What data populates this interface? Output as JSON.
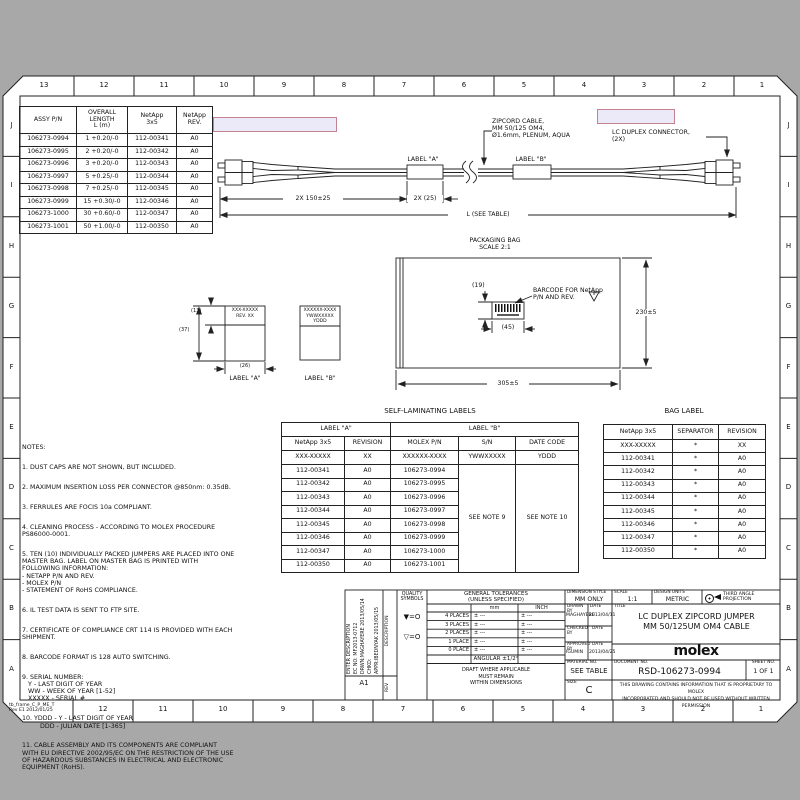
{
  "frame": {
    "cols_top": [
      "13",
      "12",
      "11",
      "10",
      "9",
      "8",
      "7",
      "6",
      "5",
      "4",
      "3",
      "2",
      "1"
    ],
    "cols_bottom": [
      "12",
      "11",
      "10",
      "9",
      "8",
      "7",
      "6",
      "5",
      "4",
      "3",
      "2",
      "1"
    ],
    "rows_left": [
      "J",
      "I",
      "H",
      "G",
      "F",
      "E",
      "D",
      "C",
      "B",
      "A"
    ],
    "rows_right": [
      "J",
      "I",
      "H",
      "G",
      "F",
      "E",
      "D",
      "C",
      "B",
      "A"
    ],
    "stamp": "tb_frame_C_P_ME_T\nRev E1 2012/01/25"
  },
  "assy_table": {
    "headers": [
      "ASSY P/N",
      "OVERALL\nLENGTH\nL (m)",
      "NetApp\n3x5",
      "NetApp\nREV."
    ],
    "rows": [
      [
        "106273-0994",
        "1 +0.20/-0",
        "112-00341",
        "A0"
      ],
      [
        "106273-0995",
        "2 +0.20/-0",
        "112-00342",
        "A0"
      ],
      [
        "106273-0996",
        "3 +0.20/-0",
        "112-00343",
        "A0"
      ],
      [
        "106273-0997",
        "5 +0.25/-0",
        "112-00344",
        "A0"
      ],
      [
        "106273-0998",
        "7 +0.25/-0",
        "112-00345",
        "A0"
      ],
      [
        "106273-0999",
        "15 +0.30/-0",
        "112-00346",
        "A0"
      ],
      [
        "106273-1000",
        "30 +0.60/-0",
        "112-00347",
        "A0"
      ],
      [
        "106273-1001",
        "50 +1.00/-0",
        "112-00350",
        "A0"
      ]
    ]
  },
  "cable": {
    "callout_cable": "ZIPCORD CABLE,\nMM 50/125 OM4,\nØ1.6mm, PLENUM, AQUA",
    "callout_connector": "LC DUPLEX CONNECTOR,\n(2X)",
    "label_a": "LABEL \"A\"",
    "label_b": "LABEL \"B\"",
    "dim_boot": "2X 150±25",
    "dim_label": "2X (25)",
    "dim_length": "L (SEE TABLE)"
  },
  "bag": {
    "title": "PACKAGING BAG\nSCALE 2:1",
    "dim_height": "230±5",
    "dim_width": "305±5",
    "dim_barcode_h": "(19)",
    "dim_barcode_w": "(45)",
    "callout_barcode": "BARCODE FOR NetApp\nP/N AND REV.",
    "flag": "V"
  },
  "labels_detail": {
    "a_text": "XXX-XXXXX\nREV. XX",
    "b_text": "XXXXXX-XXXX\nYWWXXXXX\nYDDD",
    "dim_13": "(13)",
    "dim_37": "(37)",
    "dim_26": "(26)",
    "caption_a": "LABEL \"A\"",
    "caption_b": "LABEL \"B\""
  },
  "selflam": {
    "title": "SELF-LAMINATING LABELS",
    "group_a": "LABEL \"A\"",
    "group_b": "LABEL \"B\"",
    "headers": [
      "NetApp 3x5",
      "REVISION",
      "MOLEX P/N",
      "S/N",
      "DATE CODE"
    ],
    "template_row": [
      "XXX-XXXXX",
      "XX",
      "XXXXXX-XXXX",
      "YWWXXXXX",
      "YDDD"
    ],
    "rows": [
      [
        "112-00341",
        "A0",
        "106273-0994"
      ],
      [
        "112-00342",
        "A0",
        "106273-0995"
      ],
      [
        "112-00343",
        "A0",
        "106273-0996"
      ],
      [
        "112-00344",
        "A0",
        "106273-0997"
      ],
      [
        "112-00345",
        "A0",
        "106273-0998"
      ],
      [
        "112-00346",
        "A0",
        "106273-0999"
      ],
      [
        "112-00347",
        "A0",
        "106273-1000"
      ],
      [
        "112-00350",
        "A0",
        "106273-1001"
      ]
    ],
    "sn_note": "SEE NOTE 9",
    "date_note": "SEE NOTE 10"
  },
  "baglabel": {
    "title": "BAG LABEL",
    "headers": [
      "NetApp 3x5",
      "SEPARATOR",
      "REVISION"
    ],
    "rows": [
      [
        "XXX-XXXXX",
        "*",
        "XX"
      ],
      [
        "112-00341",
        "*",
        "A0"
      ],
      [
        "112-00342",
        "*",
        "A0"
      ],
      [
        "112-00343",
        "*",
        "A0"
      ],
      [
        "112-00344",
        "*",
        "A0"
      ],
      [
        "112-00345",
        "*",
        "A0"
      ],
      [
        "112-00346",
        "*",
        "A0"
      ],
      [
        "112-00347",
        "*",
        "A0"
      ],
      [
        "112-00350",
        "*",
        "A0"
      ]
    ]
  },
  "notes": {
    "title": "NOTES:",
    "items": [
      "1. DUST CAPS ARE NOT SHOWN, BUT INCLUDED.",
      "2. MAXIMUM INSERTION LOSS PER CONNECTOR @850nm: 0.35dB.",
      "3. FERRULES ARE FOCIS 10a COMPLIANT.",
      "4. CLEANING PROCESS - ACCORDING TO MOLEX PROCEDURE\nPS86000-0001.",
      "5. TEN (10) INDIVIDUALLY PACKED JUMPERS ARE PLACED INTO ONE\nMASTER BAG. LABEL ON MASTER BAG IS PRINTED WITH\nFOLLOWING INFORMATION:\n- NETAPP P/N AND REV.\n- MOLEX P/N\n- STATEMENT OF RoHS COMPLIANCE.",
      "6. IL TEST DATA IS SENT TO FTP SITE.",
      "7. CERTIFICATE OF COMPLIANCE CRT 114 IS PROVIDED WITH EACH\nSHIPMENT.",
      "8. BARCODE FORMAT IS 128 AUTO SWITCHING.",
      "9. SERIAL NUMBER:\n   Y - LAST DIGIT OF YEAR\n   WW - WEEK OF YEAR [1-52]\n   XXXXX - SERIAL #",
      "10. YDDD - Y - LAST DIGIT OF YEAR\n         DDD - JULIAN DATE [1-365]",
      "11. CABLE ASSEMBLY AND ITS COMPONENTS ARE COMPLIANT\nWITH EU DIRECTIVE 2002/95/EC ON THE RESTRICTION OF THE USE\nOF HAZARDOUS SUBSTANCES IN ELECTRICAL AND ELECTRONIC\nEQUIPMENT (RoHS)."
    ]
  },
  "titleblock": {
    "rev_desc": "ENTER DESCRIPTION\nEC NO: MF2013-0712\nDRWN:MAGHAYERE 2013/05/14\nCHKD:\nAPPR:IBEDNYAK 2013/05/15",
    "rev_code": "A1",
    "rev_label": "REV",
    "desc_label": "DESCRIPTION",
    "quality_title": "QUALITY\nSYMBOLS",
    "quality_sym1": "▼=O",
    "quality_sym2": "▽=O",
    "tol_title": "GENERAL TOLERANCES\n(UNLESS SPECIFIED)",
    "tol_col_mm": "mm",
    "tol_col_inch": "INCH",
    "tol_rows": [
      [
        "4 PLACES",
        "± ---",
        "± ---"
      ],
      [
        "3 PLACES",
        "± ---",
        "± ---"
      ],
      [
        "2 PLACES",
        "± ---",
        "± ---"
      ],
      [
        "1 PLACE",
        "± ---",
        "± ---"
      ],
      [
        "0 PLACE",
        "± ---",
        "± ---"
      ]
    ],
    "tol_angular": "ANGULAR ±1/2°",
    "tol_draft": "DRAFT WHERE APPLICABLE\nMUST REMAIN\nWITHIN DIMENSIONS",
    "dim_style_label": "DIMENSION STYLE",
    "dim_style_value": "MM ONLY",
    "scale_label": "SCALE",
    "scale_value": "1:1",
    "units_label": "DESIGN UNITS",
    "units_value": "METRIC",
    "projection": "THIRD ANGLE\nPROJECTION",
    "drawn_label": "DRAWN BY",
    "drawn_value": "MAGHAYERE",
    "date_label": "DATE",
    "drawn_date": "2013/04/11",
    "checked_label": "CHECKED BY",
    "approved_label": "APPROVED BY",
    "approved_value": "IGUMIN",
    "approved_date": "2013/04/25",
    "material_label": "MATERIAL NO.",
    "material_value": "SEE TABLE",
    "title_label": "TITLE",
    "title_value": "LC DUPLEX ZIPCORD JUMPER\nMM 50/125UM OM4 CABLE",
    "logo": "molex",
    "doc_label": "DOCUMENT NO.",
    "doc_value": "RSD-106273-0994",
    "sheet_label": "SHEET NO.",
    "sheet_value": "1 OF 1",
    "size_label": "SIZE",
    "size_value": "C",
    "proprietary": "THIS DRAWING CONTAINS INFORMATION THAT IS PROPRIETARY TO MOLEX\nINCORPORATED AND SHOULD NOT BE USED WITHOUT WRITTEN PERMISSION"
  },
  "colors": {
    "background": "#a8a8a8",
    "paper": "#ffffff",
    "ink": "#222222",
    "highlight_fill": "#eceaf8",
    "highlight_border": "#c4818f"
  }
}
